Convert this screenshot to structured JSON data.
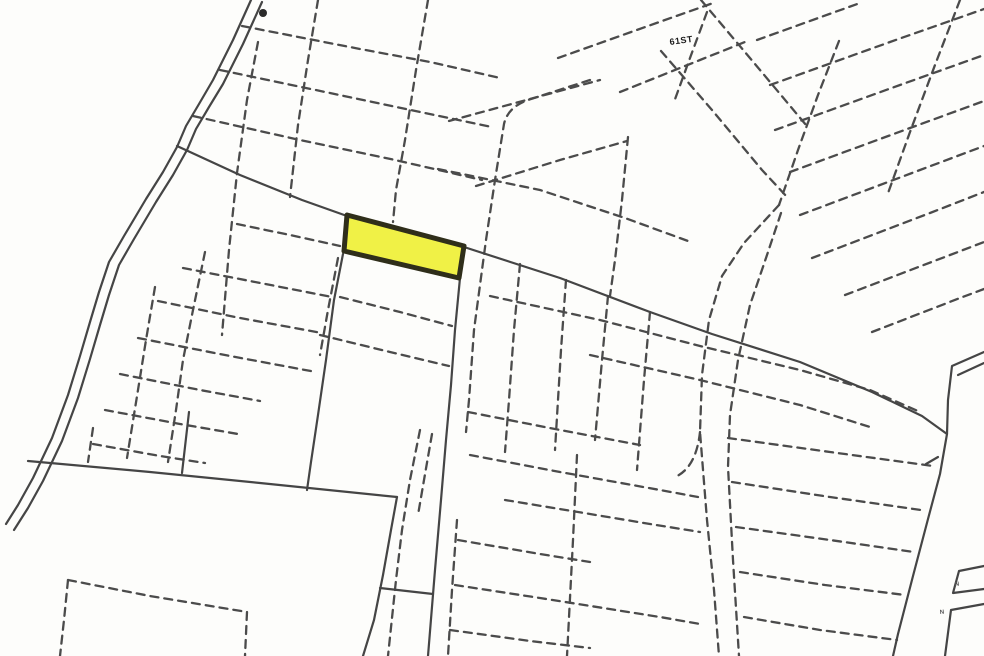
{
  "map": {
    "width": 984,
    "height": 656,
    "background": "#fdfdfb",
    "colors": {
      "solid_line": "#454545",
      "dashed_line": "#4c4c4c",
      "highlight_fill": "#eff03c",
      "highlight_stroke": "#2f2e1a",
      "label_color": "#1b1b1b",
      "small_label_color": "#555555"
    },
    "highlight_parcel": {
      "name": "highlighted-parcel",
      "points": "347,215 464,246 459,278 344,251"
    },
    "marker": {
      "cx": 263,
      "cy": 13,
      "r": 4,
      "fill": "#2a2a2a"
    },
    "labels": [
      {
        "name": "street-label-61st",
        "text": "61ST",
        "x": 670,
        "y": 45,
        "size": 9,
        "rotate": -8,
        "color": "#1b1b1b"
      },
      {
        "name": "edge-label-upper",
        "text": "N",
        "x": 955,
        "y": 586,
        "size": 6,
        "rotate": -6,
        "color": "#555555"
      },
      {
        "name": "edge-label-lower",
        "text": "N",
        "x": 940,
        "y": 614,
        "size": 6,
        "rotate": -6,
        "color": "#555555"
      }
    ],
    "solid_paths": [
      {
        "name": "stream-line-west",
        "d": "M251,0 L233,40 L213,80 L199,104 L186,126 L177,147 L163,172 L146,199 L124,236 L109,262 L99,292 L90,322 L80,356 L68,395 L52,438 L33,478 L18,505 L6,524"
      },
      {
        "name": "stream-line-east",
        "d": "M262,2 L243,44 L223,84 L209,107 L196,129 L187,150 L173,175 L156,202 L134,239 L119,265 L109,295 L100,325 L90,359 L78,398 L62,441 L43,481 L28,508 L14,530"
      },
      {
        "name": "main-road",
        "d": "M177,146 L240,175 L302,200 L347,216 L464,247 L560,278 L650,312 L712,334 L800,362 L872,392 L922,416 L947,434 L940,474 L928,519 L913,576 L898,634 L893,656"
      },
      {
        "name": "right-road-spur-a",
        "d": "M984,352 L952,366 L948,400 L947,434"
      },
      {
        "name": "right-road-spur-b",
        "d": "M984,363 L958,375"
      },
      {
        "name": "central-road-east-edge",
        "d": "M460,278 L455,330 L451,385 L446,440 L441,500 L435,570 L428,656"
      },
      {
        "name": "central-road-west-edge-upper",
        "d": "M343,254 L334,300 L326,360 L318,415 L311,462 L307,490"
      },
      {
        "name": "central-road-west-edge-lower",
        "d": "M397,497 L391,530 L383,575 L374,620 L363,656"
      },
      {
        "name": "road-crossbar",
        "d": "M380,588 L433,594"
      },
      {
        "name": "large-parcel-top-edge",
        "d": "M28,461 L150,472 L260,483 L397,497"
      },
      {
        "name": "boundary-stub",
        "d": "M189,412 L182,473"
      },
      {
        "name": "right-edge-box-upper",
        "d": "M984,566 L959,571 L953,593 L984,589"
      },
      {
        "name": "right-edge-box-lower",
        "d": "M984,604 L951,610 L945,656"
      },
      {
        "name": "road-tick",
        "d": "M938,457 L926,464"
      }
    ],
    "dashed_paths": [
      "M258,42 L247,100 L237,173 L229,250 L222,335",
      "M318,0 L308,60 L298,125 L290,197",
      "M428,0 L416,70 L405,140 L396,190 L393,222",
      "M338,258 L328,310 L320,355",
      "M590,80 L531,99 Q508,106 504,124 L495,180 L486,240 L474,330 L469,400 L466,432",
      "M242,26 L360,49 L430,62 L500,78",
      "M220,70 L330,93 L420,112 L492,127",
      "M193,116 L300,140 L395,160 L482,180",
      "M438,169 L540,190 L625,218 L688,241",
      "M628,137 L622,200 L615,260 L610,296",
      "M449,121 L530,99 L600,80",
      "M476,186 L560,160 L627,141",
      "M661,51 L712,110 L762,170 L788,198",
      "M839,41 L818,95 L798,150 L779,205",
      "M779,205 L744,243 L722,276 L709,320 L702,375 L700,432 L707,520 L714,590 L719,656",
      "M781,213 L766,258 L750,305 L738,360 L730,415 L728,467 L733,560 L739,656",
      "M558,58 L648,26 L716,2",
      "M620,92 L700,60 L745,42",
      "M757,40 L860,3",
      "M770,85 L890,42 L984,9",
      "M775,130 L900,85 L984,55",
      "M790,172 L910,128 L984,101",
      "M800,215 L920,170 L984,146",
      "M812,258 L930,213 L984,192",
      "M845,295 L950,255 L984,242",
      "M872,332 L960,298 L984,289",
      "M701,0 L755,64 L806,125",
      "M707,12 L690,58 L674,102",
      "M960,0 L935,65 L910,132 L887,196",
      "M237,224 L290,235 L340,246",
      "M183,268 L250,281 L332,297",
      "M158,301 L240,318 L322,333",
      "M138,338 L230,356 L316,372",
      "M120,374 L200,390 L260,401",
      "M105,410 L180,424 L238,434",
      "M93,444 L160,456 L205,463",
      "M205,252 L193,310 L183,360 L176,410 L168,462",
      "M155,287 L146,340 L138,390 L127,458",
      "M93,428 L88,462",
      "M420,430 L410,480 L402,530 L396,580 L388,656",
      "M432,434 L424,480 L418,515",
      "M340,297 L400,312 L452,326",
      "M320,335 L390,352 L449,366",
      "M520,264 L514,330 L509,400 L505,452",
      "M566,280 L561,350 L555,450",
      "M577,455 L573,540 L567,656",
      "M608,296 L602,360 L595,440",
      "M650,312 L644,380 L637,470",
      "M457,520 L452,590 L448,656",
      "M468,412 L560,430 L640,445",
      "M470,455 L560,472 L660,490 L698,497",
      "M505,500 L578,512 L650,524 L700,532",
      "M458,540 L540,554 L590,562",
      "M455,585 L540,598 L660,617 L700,624",
      "M450,630 L530,641 L590,648",
      "M700,432 Q696,468 675,477",
      "M728,438 L830,452 L933,466",
      "M732,482 L830,497 L921,510",
      "M736,527 L830,540 L914,552",
      "M740,572 L825,585 L905,595",
      "M744,617 L820,630 L897,640",
      "M490,296 L600,320 L700,346 L800,370 L870,390 L920,412",
      "M590,355 L700,380 L800,405 L870,427",
      "M68,580 L64,620 L60,656",
      "M68,580 L150,596 L247,612",
      "M247,612 L245,656"
    ]
  }
}
